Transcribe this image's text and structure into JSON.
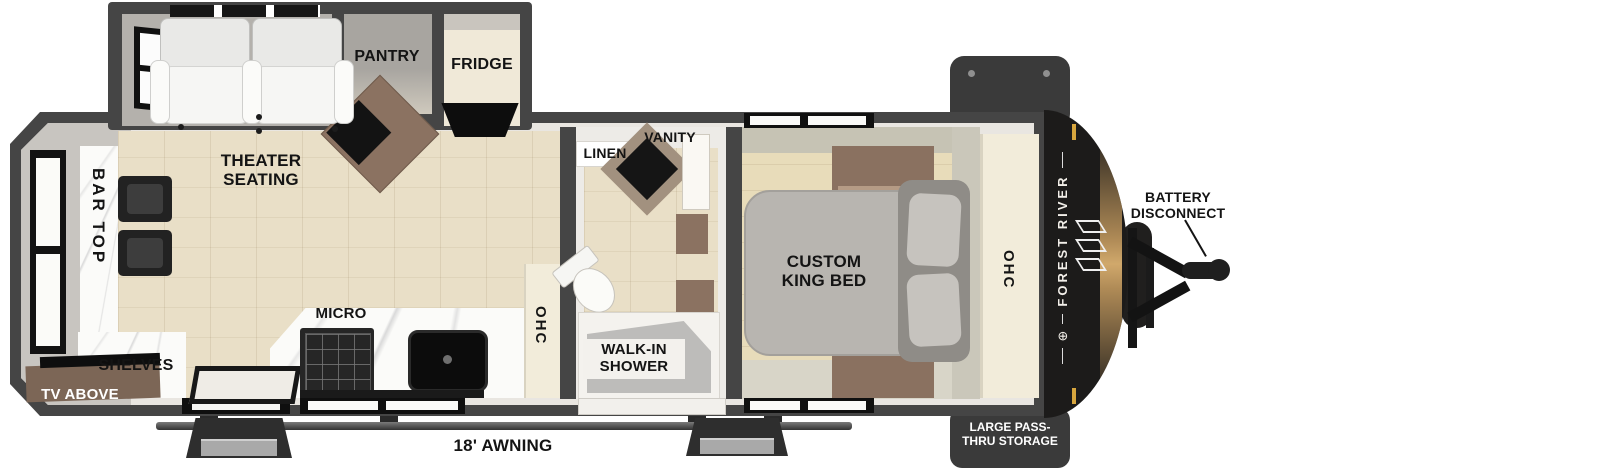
{
  "plan_labels": {
    "theater_seating": "THEATER SEATING",
    "pantry": "PANTRY",
    "fridge": "FRIDGE",
    "bar_top": "BAR TOP",
    "shelves": "SHELVES",
    "tv_above": "TV ABOVE",
    "micro": "MICRO",
    "kitchen_ohc": "OHC",
    "linen": "LINEN",
    "vanity": "VANITY",
    "walk_in_shower": "WALK-IN SHOWER",
    "custom_king_bed": "CUSTOM KING BED",
    "bedroom_ohc": "OHC"
  },
  "exterior_labels": {
    "brand": "FOREST RIVER",
    "battery_disconnect": "BATTERY DISCONNECT",
    "large_pass_thru_storage": "LARGE PASS-THRU STORAGE",
    "awning": "18' AWNING"
  },
  "colors": {
    "wall": "#454545",
    "front_cap": "#1c1b1a",
    "amber_accent": "#c99e61",
    "gold_tick": "#d7a63e",
    "wood_floor": "#e9dfc7",
    "bedroom_floor": "#e8dcba",
    "cabinet_brown": "#8a7160",
    "cabinet_cream": "#f2ecda",
    "bed_gray": "#b8b5b0"
  }
}
